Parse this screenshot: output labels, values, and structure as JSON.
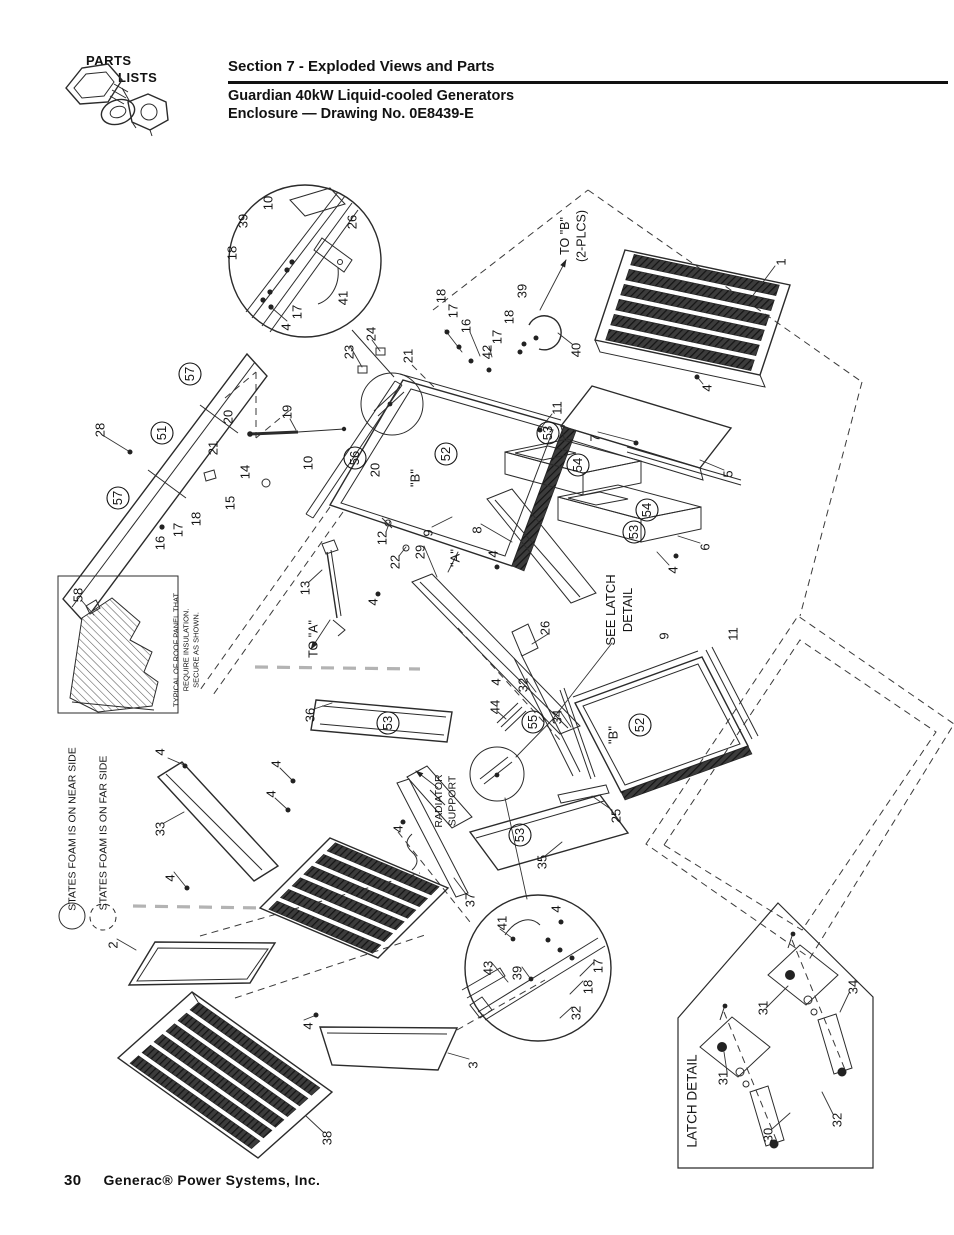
{
  "header": {
    "logo_line1": "PARTS",
    "logo_line2": "LISTS",
    "section_title": "Section 7 - Exploded Views and Parts",
    "subtitle1": "Guardian 40kW Liquid-cooled Generators",
    "subtitle2": "Enclosure — Drawing No. 0E8439-E"
  },
  "footer": {
    "page_number": "30",
    "company": "Generac® Power Systems, Inc."
  },
  "colors": {
    "ink": "#2b2b2b",
    "paper": "#ffffff"
  },
  "diagram": {
    "callouts": [
      {
        "t": "10",
        "x": 268,
        "y": 203
      },
      {
        "t": "39",
        "x": 243,
        "y": 221
      },
      {
        "t": "18",
        "x": 232,
        "y": 253
      },
      {
        "t": "26",
        "x": 352,
        "y": 222
      },
      {
        "t": "41",
        "x": 343,
        "y": 298
      },
      {
        "t": "17",
        "x": 297,
        "y": 312
      },
      {
        "t": "4",
        "x": 286,
        "y": 327
      },
      {
        "t": "23",
        "x": 349,
        "y": 352
      },
      {
        "t": "24",
        "x": 371,
        "y": 334
      },
      {
        "t": "21",
        "x": 408,
        "y": 356
      },
      {
        "t": "18",
        "x": 441,
        "y": 296
      },
      {
        "t": "17",
        "x": 453,
        "y": 311
      },
      {
        "t": "16",
        "x": 466,
        "y": 326
      },
      {
        "t": "42",
        "x": 487,
        "y": 352
      },
      {
        "t": "17",
        "x": 497,
        "y": 337
      },
      {
        "t": "18",
        "x": 509,
        "y": 317
      },
      {
        "t": "39",
        "x": 522,
        "y": 291
      },
      {
        "t": "40",
        "x": 576,
        "y": 350
      },
      {
        "t": "1",
        "x": 781,
        "y": 262
      },
      {
        "t": "4",
        "x": 707,
        "y": 388
      },
      {
        "t": "7",
        "x": 595,
        "y": 438
      },
      {
        "t": "5",
        "x": 728,
        "y": 474
      },
      {
        "t": "28",
        "x": 100,
        "y": 430
      },
      {
        "t": "57",
        "x": 190,
        "y": 374,
        "c": true
      },
      {
        "t": "51",
        "x": 162,
        "y": 433,
        "c": true
      },
      {
        "t": "57",
        "x": 118,
        "y": 498,
        "c": true
      },
      {
        "t": "20",
        "x": 228,
        "y": 417
      },
      {
        "t": "21",
        "x": 213,
        "y": 448
      },
      {
        "t": "19",
        "x": 287,
        "y": 412
      },
      {
        "t": "14",
        "x": 245,
        "y": 472
      },
      {
        "t": "15",
        "x": 230,
        "y": 503
      },
      {
        "t": "18",
        "x": 196,
        "y": 519
      },
      {
        "t": "17",
        "x": 178,
        "y": 530
      },
      {
        "t": "16",
        "x": 160,
        "y": 543
      },
      {
        "t": "10",
        "x": 308,
        "y": 463
      },
      {
        "t": "56",
        "x": 355,
        "y": 458,
        "c": true
      },
      {
        "t": "20",
        "x": 375,
        "y": 470
      },
      {
        "t": "\"B\"",
        "x": 415,
        "y": 478
      },
      {
        "t": "52",
        "x": 446,
        "y": 454,
        "c": true
      },
      {
        "t": "11",
        "x": 557,
        "y": 408
      },
      {
        "t": "53",
        "x": 548,
        "y": 433,
        "c": true
      },
      {
        "t": "54",
        "x": 578,
        "y": 465,
        "c": true
      },
      {
        "t": "9",
        "x": 428,
        "y": 533
      },
      {
        "t": "8",
        "x": 477,
        "y": 530
      },
      {
        "t": "12",
        "x": 382,
        "y": 538
      },
      {
        "t": "22",
        "x": 395,
        "y": 562
      },
      {
        "t": "29",
        "x": 420,
        "y": 552
      },
      {
        "t": "\"A\"",
        "x": 455,
        "y": 558
      },
      {
        "t": "13",
        "x": 305,
        "y": 588
      },
      {
        "t": "4",
        "x": 373,
        "y": 602
      },
      {
        "t": "4",
        "x": 493,
        "y": 554
      },
      {
        "t": "54",
        "x": 647,
        "y": 510,
        "c": true
      },
      {
        "t": "53",
        "x": 634,
        "y": 532,
        "c": true
      },
      {
        "t": "6",
        "x": 705,
        "y": 547
      },
      {
        "t": "4",
        "x": 673,
        "y": 570
      },
      {
        "t": "9",
        "x": 664,
        "y": 636
      },
      {
        "t": "11",
        "x": 733,
        "y": 634
      },
      {
        "t": "\"B\"",
        "x": 613,
        "y": 735
      },
      {
        "t": "52",
        "x": 640,
        "y": 725,
        "c": true
      },
      {
        "t": "25",
        "x": 616,
        "y": 816
      },
      {
        "t": "26",
        "x": 545,
        "y": 628
      },
      {
        "t": "4",
        "x": 496,
        "y": 682
      },
      {
        "t": "32",
        "x": 523,
        "y": 685
      },
      {
        "t": "36",
        "x": 310,
        "y": 715
      },
      {
        "t": "53",
        "x": 388,
        "y": 723,
        "c": true
      },
      {
        "t": "44",
        "x": 495,
        "y": 707
      },
      {
        "t": "55",
        "x": 533,
        "y": 722,
        "c": true
      },
      {
        "t": "34",
        "x": 557,
        "y": 717
      },
      {
        "t": "4",
        "x": 398,
        "y": 829
      },
      {
        "t": "53",
        "x": 520,
        "y": 835,
        "c": true
      },
      {
        "t": "35",
        "x": 542,
        "y": 862
      },
      {
        "t": "33",
        "x": 160,
        "y": 829
      },
      {
        "t": "4",
        "x": 160,
        "y": 752
      },
      {
        "t": "4",
        "x": 170,
        "y": 878
      },
      {
        "t": "4",
        "x": 276,
        "y": 764
      },
      {
        "t": "4",
        "x": 271,
        "y": 794
      },
      {
        "t": "2",
        "x": 113,
        "y": 945
      },
      {
        "t": "4",
        "x": 308,
        "y": 1026
      },
      {
        "t": "38",
        "x": 327,
        "y": 1138
      },
      {
        "t": "3",
        "x": 473,
        "y": 1065
      },
      {
        "t": "37",
        "x": 470,
        "y": 900
      },
      {
        "t": "41",
        "x": 502,
        "y": 923
      },
      {
        "t": "4",
        "x": 556,
        "y": 909
      },
      {
        "t": "43",
        "x": 488,
        "y": 968
      },
      {
        "t": "39",
        "x": 517,
        "y": 973
      },
      {
        "t": "18",
        "x": 588,
        "y": 987
      },
      {
        "t": "17",
        "x": 598,
        "y": 966
      },
      {
        "t": "32",
        "x": 576,
        "y": 1013
      },
      {
        "t": "31",
        "x": 763,
        "y": 1008
      },
      {
        "t": "34",
        "x": 853,
        "y": 987
      },
      {
        "t": "31",
        "x": 723,
        "y": 1078
      },
      {
        "t": "30",
        "x": 768,
        "y": 1135
      },
      {
        "t": "32",
        "x": 837,
        "y": 1120
      },
      {
        "t": "58",
        "x": 78,
        "y": 595
      }
    ],
    "notes": [
      {
        "lines": [
          "TO \"B\"",
          "(2-PLCS)"
        ],
        "x": 573,
        "y": 236,
        "size": 12.5
      },
      {
        "lines": [
          "TO \"A\""
        ],
        "x": 313,
        "y": 639,
        "size": 12.5
      },
      {
        "lines": [
          "SEE LATCH",
          "DETAIL"
        ],
        "x": 619,
        "y": 610,
        "size": 13
      },
      {
        "lines": [
          "RADIATOR",
          "SUPPORT"
        ],
        "x": 445,
        "y": 801,
        "size": 10.5
      },
      {
        "lines": [
          "LATCH DETAIL"
        ],
        "x": 692,
        "y": 1101,
        "size": 13.5
      },
      {
        "lines": [
          "TYPICAL OF ROOF PANEL THAT",
          "REQUIRE INSULATION.",
          "SECURE AS SHOWN."
        ],
        "x": 186,
        "y": 650,
        "size": 7.5
      },
      {
        "lines": [
          "STATES FOAM IS ON NEAR SIDE"
        ],
        "x": 72,
        "y": 829,
        "size": 10.5
      },
      {
        "lines": [
          "STATES FOAM IS ON FAR SIDE"
        ],
        "x": 103,
        "y": 833,
        "size": 10.5
      }
    ]
  }
}
